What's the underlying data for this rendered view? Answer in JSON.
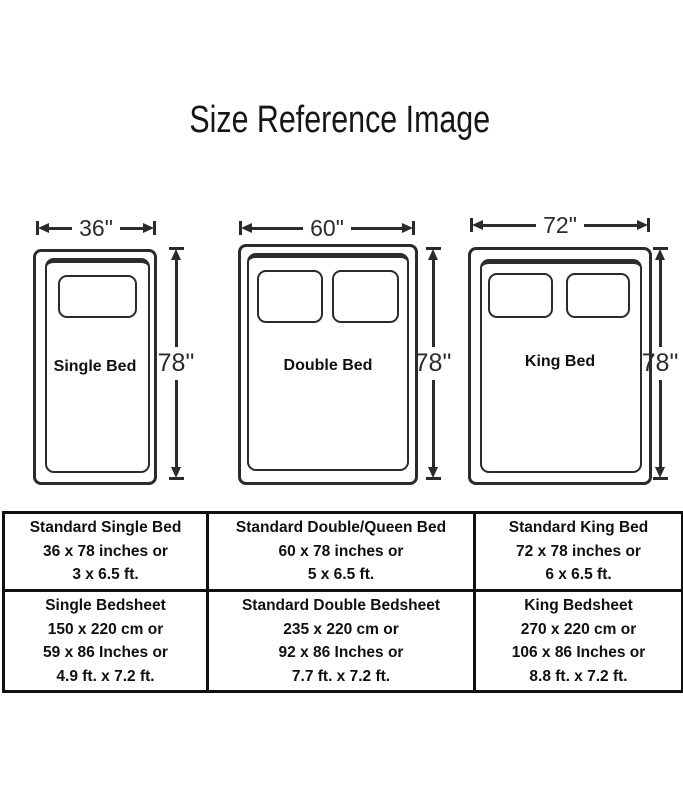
{
  "title": "Size Reference Image",
  "colors": {
    "background": "#ffffff",
    "line": "#2b2b2b",
    "text": "#101010"
  },
  "beds": [
    {
      "name": "Single Bed",
      "width_label": "36\"",
      "height_label": "78\"",
      "pillows": 1
    },
    {
      "name": "Double Bed",
      "width_label": "60\"",
      "height_label": "78\"",
      "pillows": 2
    },
    {
      "name": "King Bed",
      "width_label": "72\"",
      "height_label": "78\"",
      "pillows": 2
    }
  ],
  "table": {
    "rows": [
      {
        "cells": [
          {
            "lines": [
              "Standard Single Bed",
              "36 x 78 inches or",
              "3 x 6.5 ft."
            ]
          },
          {
            "lines": [
              "Standard Double/Queen Bed",
              "60 x 78 inches or",
              "5 x 6.5 ft."
            ]
          },
          {
            "lines": [
              "Standard King Bed",
              "72 x 78 inches or",
              "6 x 6.5 ft."
            ]
          }
        ]
      },
      {
        "cells": [
          {
            "lines": [
              "Single Bedsheet",
              "150 x 220 cm or",
              "59 x 86 Inches or",
              "4.9 ft. x 7.2 ft."
            ]
          },
          {
            "lines": [
              "Standard Double Bedsheet",
              "235 x 220 cm or",
              "92 x 86 Inches or",
              "7.7 ft. x 7.2 ft."
            ]
          },
          {
            "lines": [
              "King Bedsheet",
              "270 x 220 cm or",
              "106 x 86 Inches or",
              "8.8 ft. x 7.2 ft."
            ]
          }
        ]
      }
    ]
  }
}
